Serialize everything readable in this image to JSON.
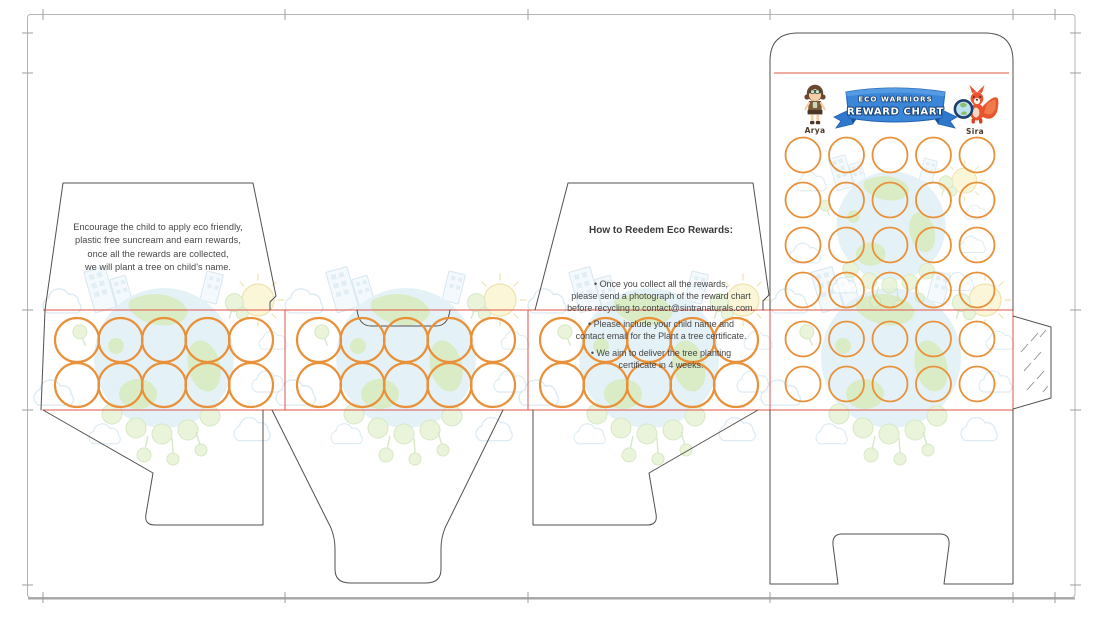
{
  "colors": {
    "accent_orange": "#E8913A",
    "fold_red": "#E0564A",
    "cut_gray": "#55504C",
    "border_gray": "#B5B5B5",
    "trim_gray": "#9AA0A4",
    "banner_blue": "#3A86D8",
    "banner_blue_dark": "#2261B0",
    "banner_outline": "#17437F",
    "text_dark": "#474747",
    "globe_blue": "#D9EDF5",
    "land_green": "#CBE4AD",
    "tree_green": "#E0F0CD",
    "sun_yellow": "#FAF3C8",
    "cloud_outline": "#CFE3EE",
    "fox_orange": "#E8542E"
  },
  "left_flap": {
    "text": "Encourage the child to apply eco friendly,\nplastic free suncream and earn rewards,\nonce all the rewards are collected,\nwe will plant a tree on child's name."
  },
  "redeem_panel": {
    "heading": "How to Reedem Eco Rewards:",
    "bullets": [
      "• Once you collect all the rewards,\nplease send a photograph of the reward chart\nbefore recycling to contact@sintranaturals.com.",
      "• Please include your child name and\ncontact email for the Plant a tree certificate.",
      "• We aim to deliver the tree planting\ncertificate in 4 weeks."
    ],
    "contact_email": "contact@sintranaturals.com"
  },
  "front_panel": {
    "banner": {
      "line1": "ECO WARRIORS",
      "line2": "REWARD CHART"
    },
    "characters": [
      {
        "name": "Arya"
      },
      {
        "name": "Sira"
      }
    ],
    "reward_chart": {
      "rows": 6,
      "columns": 5,
      "total_stickers": 30
    }
  },
  "strip": {
    "sections": 4,
    "rows_per_section": 2,
    "circles_per_row": 5
  }
}
